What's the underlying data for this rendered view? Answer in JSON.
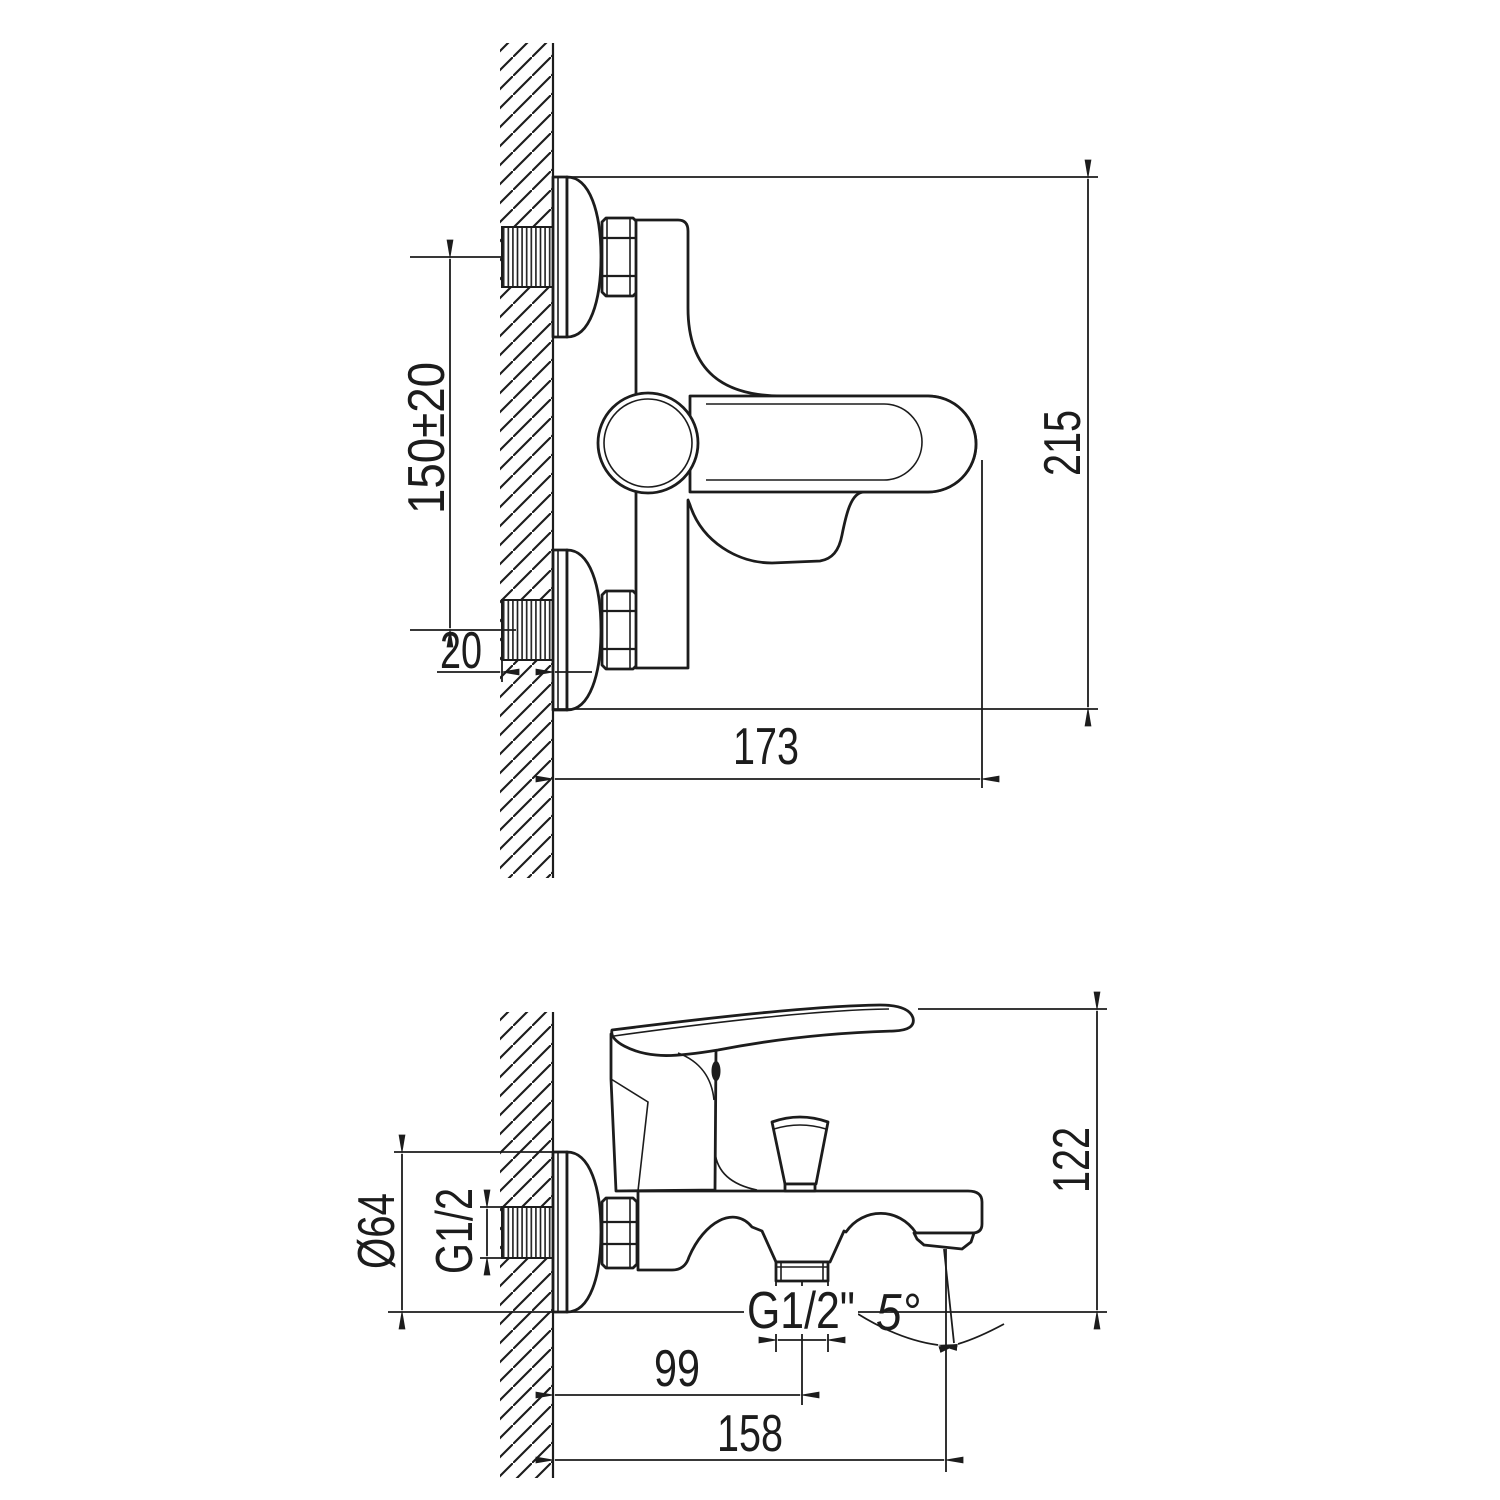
{
  "drawing": {
    "type": "technical installation drawing, wall-mounted bath mixer faucet, two orthographic views",
    "colors": {
      "line": "#1c1c1c",
      "background": "#ffffff"
    },
    "front_view": {
      "dims": {
        "mount_spacing": "150±20",
        "thread_protrusion": "20",
        "overall_width": "173",
        "overall_height": "215"
      }
    },
    "side_view": {
      "dims": {
        "escutcheon_diameter": "Ø64",
        "inlet_thread": "G1/2",
        "overall_height": "122",
        "hose_outlet_offset": "99",
        "spout_reach": "158",
        "hose_outlet_thread": "G1/2\"",
        "spout_angle": "5°"
      }
    }
  }
}
